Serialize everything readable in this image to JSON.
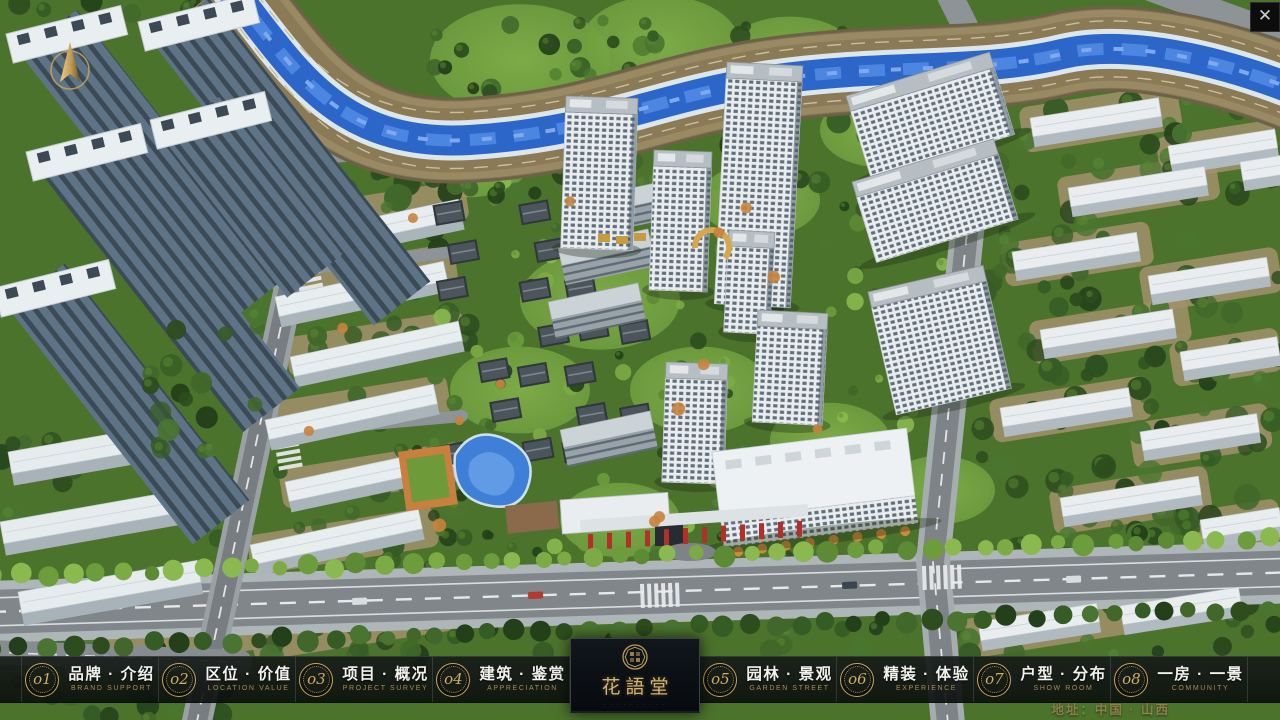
{
  "window": {
    "close_icon": "✕"
  },
  "nav": {
    "items": [
      {
        "num": "o1",
        "zh": "品牌 · 介绍",
        "en": "BRAND SUPPORT"
      },
      {
        "num": "o2",
        "zh": "区位 · 价值",
        "en": "LOCATION VALUE"
      },
      {
        "num": "o3",
        "zh": "项目 · 概况",
        "en": "PROJECT SURVEY"
      },
      {
        "num": "o4",
        "zh": "建筑 · 鉴赏",
        "en": "APPRECIATION"
      },
      {
        "num": "o5",
        "zh": "园林 · 景观",
        "en": "GARDEN STREET"
      },
      {
        "num": "o6",
        "zh": "精装 · 体验",
        "en": "EXPERIENCE"
      },
      {
        "num": "o7",
        "zh": "户型 · 分布",
        "en": "SHOW ROOM"
      },
      {
        "num": "o8",
        "zh": "一房 · 一景",
        "en": "COMMUNITY"
      }
    ]
  },
  "logo": {
    "name": "花語堂",
    "tagline": "· · · · · · · · · ·"
  },
  "footer": {
    "address": "地址：中国 · 山西"
  },
  "colors": {
    "gold": "#c9a25e",
    "river": "#2b66c8",
    "bar_bg": "rgba(14,19,17,0.9)",
    "lawn": "#74a440",
    "forest": "#2d4d1f"
  }
}
